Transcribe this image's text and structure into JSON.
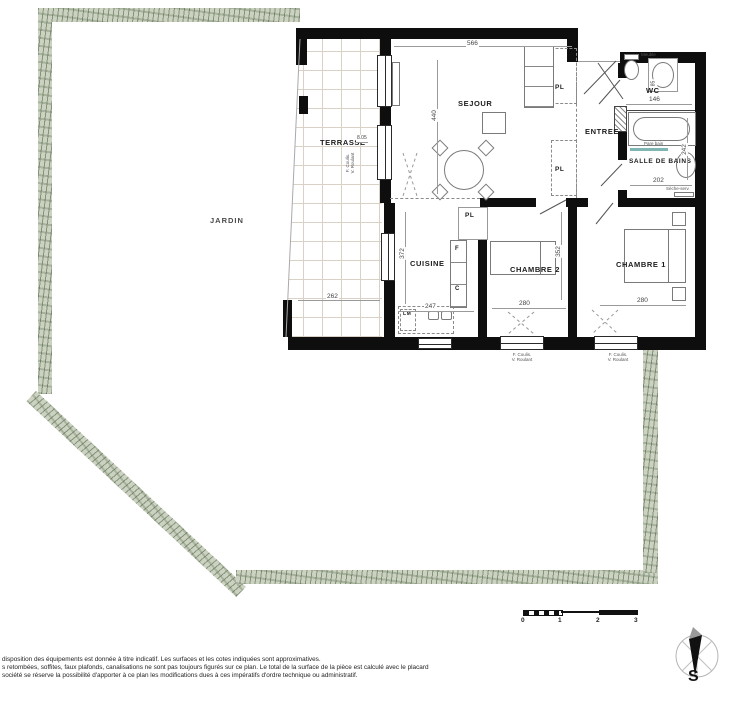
{
  "labels": {
    "sejour": "SEJOUR",
    "terrasse": "TERRASSE",
    "jardin": "JARDIN",
    "cuisine": "CUISINE",
    "entree": "ENTREE",
    "wc": "WC",
    "salle_de_bains": "SALLE DE BAINS",
    "chambre1": "CHAMBRE 1",
    "chambre2": "CHAMBRE 2",
    "placard": "PL"
  },
  "dimensions": {
    "sejour_largeur": "566",
    "sejour_profondeur": "440",
    "terrasse_largeur": "262",
    "terrasse_cote": "8.05",
    "cuisine_profondeur": "372",
    "cuisine_largeur": "247",
    "chambre2_largeur": "280",
    "chambre2_profondeur": "352",
    "chambre1_largeur": "280",
    "wc_largeur": "146",
    "wc_cote": "85",
    "sdb_largeur": "202",
    "sdb_profondeur": "242"
  },
  "appliances": {
    "refrigerateur": "F",
    "cuisson": "C",
    "lave_machine": "LM"
  },
  "annotations": {
    "fenetre": "F. Coulis.",
    "volet": "V. Roulant",
    "pare_bain": "Pare bain",
    "meuble": "Meuble",
    "seche_serviettes": "Sèche-serv."
  },
  "scale_bar": {
    "t0": "0",
    "t1": "1",
    "t2": "2",
    "t3": "3"
  },
  "compass": {
    "south": "S"
  },
  "footer": {
    "line1": "disposition des équipements est donnée à titre indicatif. Les surfaces et les cotes indiquées sont approximatives.",
    "line2": "s retombées, soffites, faux plafonds, canalisations ne sont pas toujours figurés sur ce plan. Le total de la surface de la pièce est calculé avec le placard",
    "line3": "société se réserve la possibilité d'apporter à ce plan les modifications dues à ces impératifs d'ordre technique ou administratif."
  },
  "colors": {
    "garden_band": "#ccd2c2",
    "wall": "#111111",
    "bath_screen": "#7fb5b2"
  }
}
